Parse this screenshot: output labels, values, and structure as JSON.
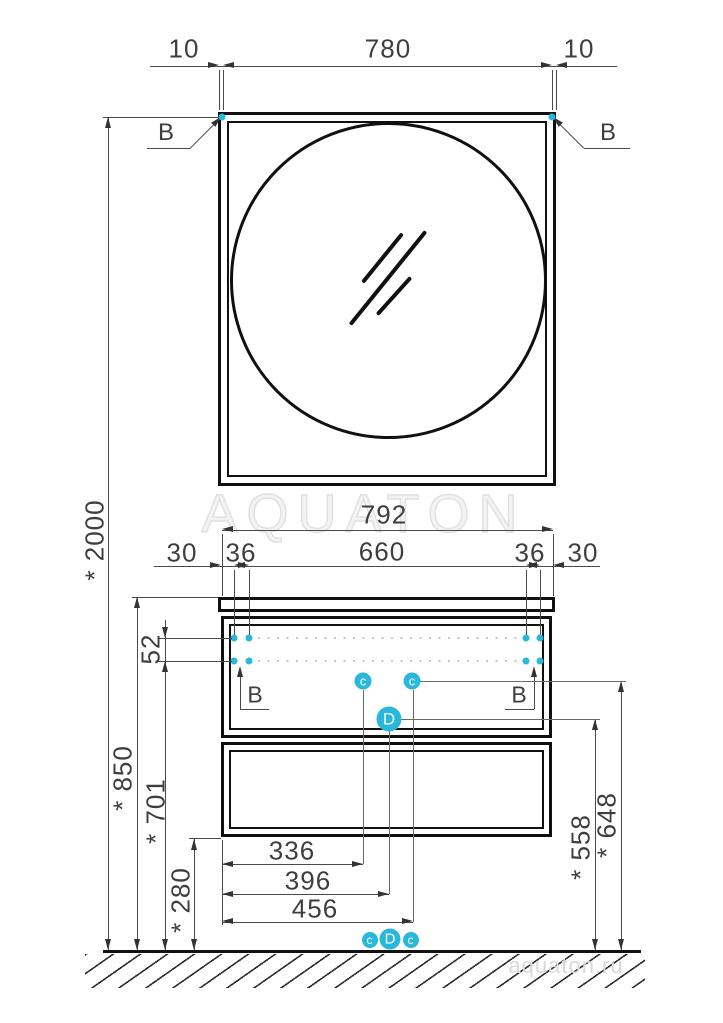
{
  "drawing": {
    "brand_watermark": "AQUATON",
    "site_watermark": "aquaton.ru",
    "accent_color": "#29b8dc",
    "mirror": {
      "offset_left": "10",
      "mount_span": "780",
      "offset_right": "10",
      "mount_label_left": "B",
      "mount_label_right": "B"
    },
    "cabinet": {
      "width": "792",
      "chain": [
        "30",
        "36",
        "660",
        "36",
        "30"
      ],
      "dowel_label_left": "B",
      "dowel_label_right": "B"
    },
    "heights": {
      "overall": "* 2000",
      "worktop": "* 850",
      "dowel_gap": "52",
      "dowel_row": "* 701",
      "clearance": "* 280",
      "marker_d": "* 558",
      "marker_c": "* 648"
    },
    "bottom_offsets": [
      "336",
      "396",
      "456"
    ],
    "markers": {
      "c": "c",
      "d": "D"
    }
  }
}
